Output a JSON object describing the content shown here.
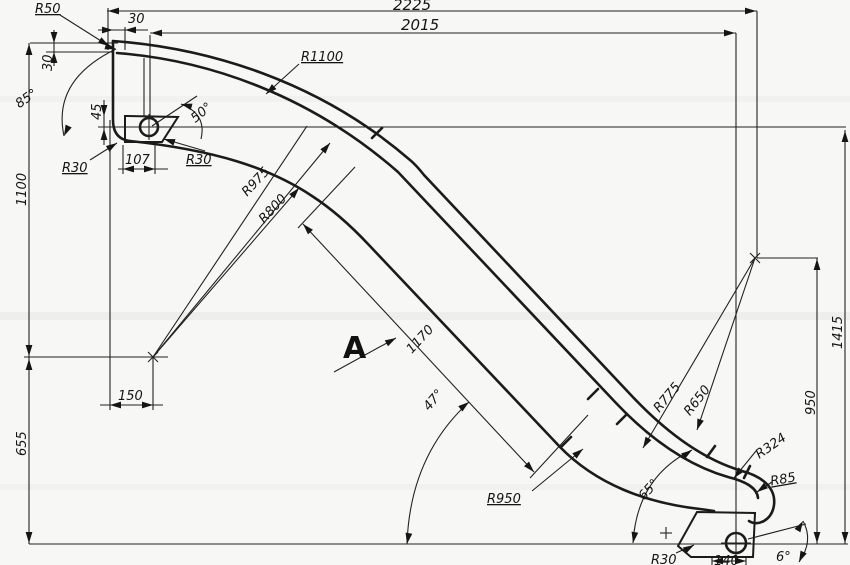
{
  "drawing": {
    "type": "technical-drawing-slide-profile",
    "background_color": "#f7f7f5",
    "line_color": "#1b1b1b",
    "view_label": "A",
    "horizontal_dims": {
      "overall_width": "2225",
      "hole_span_width": "2015",
      "top_offset": "30",
      "mount_plate_width": "107",
      "base_offset": "150",
      "bottom_mount_width": "140"
    },
    "vertical_dims": {
      "right_overall_height": "1415",
      "right_inner_height": "950",
      "left_upper_height": "1100",
      "left_lower_height": "655",
      "deck_thickness": "30",
      "hole_to_plate_top": "45"
    },
    "path_dims": {
      "straight_section_length": "1170"
    },
    "radii": {
      "r50": "R50",
      "r1100": "R1100",
      "r30_top_left": "R30",
      "r30_top_right": "R30",
      "r975": "R975",
      "r800": "R800",
      "r950": "R950",
      "r775": "R775",
      "r650": "R650",
      "r324": "R324",
      "r85": "R85",
      "r30_bottom": "R30"
    },
    "angles": {
      "top_mount_angle": "85°",
      "top_exit_angle": "50°",
      "slope_angle": "47°",
      "bottom_entry_angle": "65°",
      "bottom_exit_angle": "6°"
    }
  }
}
